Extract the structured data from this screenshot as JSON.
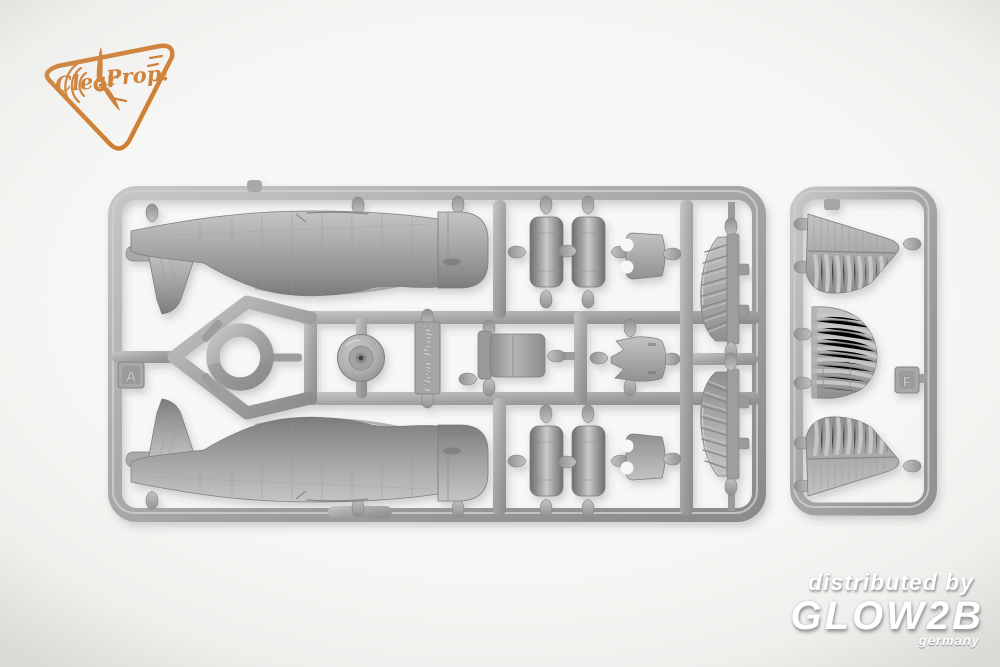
{
  "logo": {
    "word1": "Clear",
    "word2": "Prop!"
  },
  "sprue_a": {
    "tag": "A",
    "molded_brand": "Clear Prop!"
  },
  "sprue_f": {
    "tag": "F"
  },
  "watermark": {
    "line1": "distributed by",
    "line2": "GLOW2B",
    "line3": "germany"
  },
  "palette": {
    "background": "#f7f7f5",
    "plastic_light": "#cccccc",
    "plastic_mid": "#a3a3a3",
    "plastic_dark": "#7c7c7c",
    "logo_orange": "#cf7c2e"
  }
}
